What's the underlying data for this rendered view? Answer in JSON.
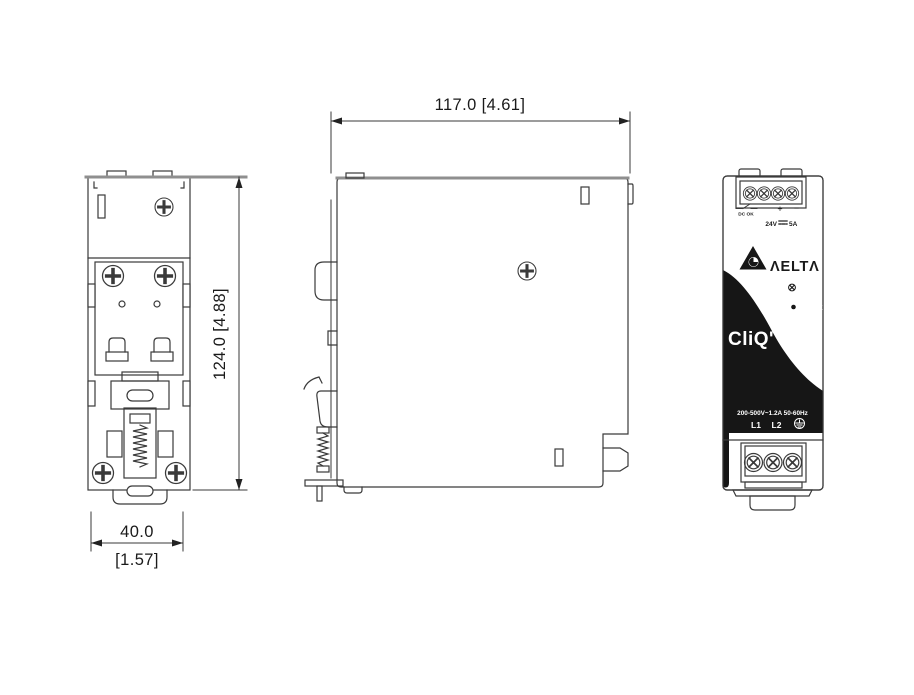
{
  "drawing_title": "DIN-rail power supply 3-view dimension drawing",
  "dimensions": {
    "side_width": "117.0  [4.61]",
    "overall_height": "124.0  [4.88]",
    "front_width_mm": "40.0",
    "front_width_in": "[1.57]"
  },
  "front_panel": {
    "relay_label": "DC OK",
    "plus": "+",
    "minus": "−",
    "output_voltage": "24V",
    "output_current": "5A",
    "brand": "ΛELTΛ",
    "adjust_label": "Adjust",
    "led_label": "DC OK",
    "product_logo": "CliQ'",
    "input_rating": "200-500V~1.2A 50-60Hz",
    "terminal_l1": "L1",
    "terminal_l2": "L2"
  },
  "icons": {
    "delta_mark": "delta-triangle-icon",
    "relay_contact": "relay-contact-icon",
    "dc_symbol": "dc-voltage-icon",
    "ground": "earth-ground-icon",
    "adjust_knob": "adjust-knob-icon",
    "dc_ok_led": "dc-ok-led-icon",
    "screws": "phillips-screw-icon",
    "terminal_screws": "terminal-screw-icon",
    "spring": "din-clip-spring-icon"
  },
  "colors": {
    "line": "#3a3a3a",
    "thick_edge": "#8f8f8f",
    "panel_black": "#161616",
    "background": "#ffffff"
  }
}
